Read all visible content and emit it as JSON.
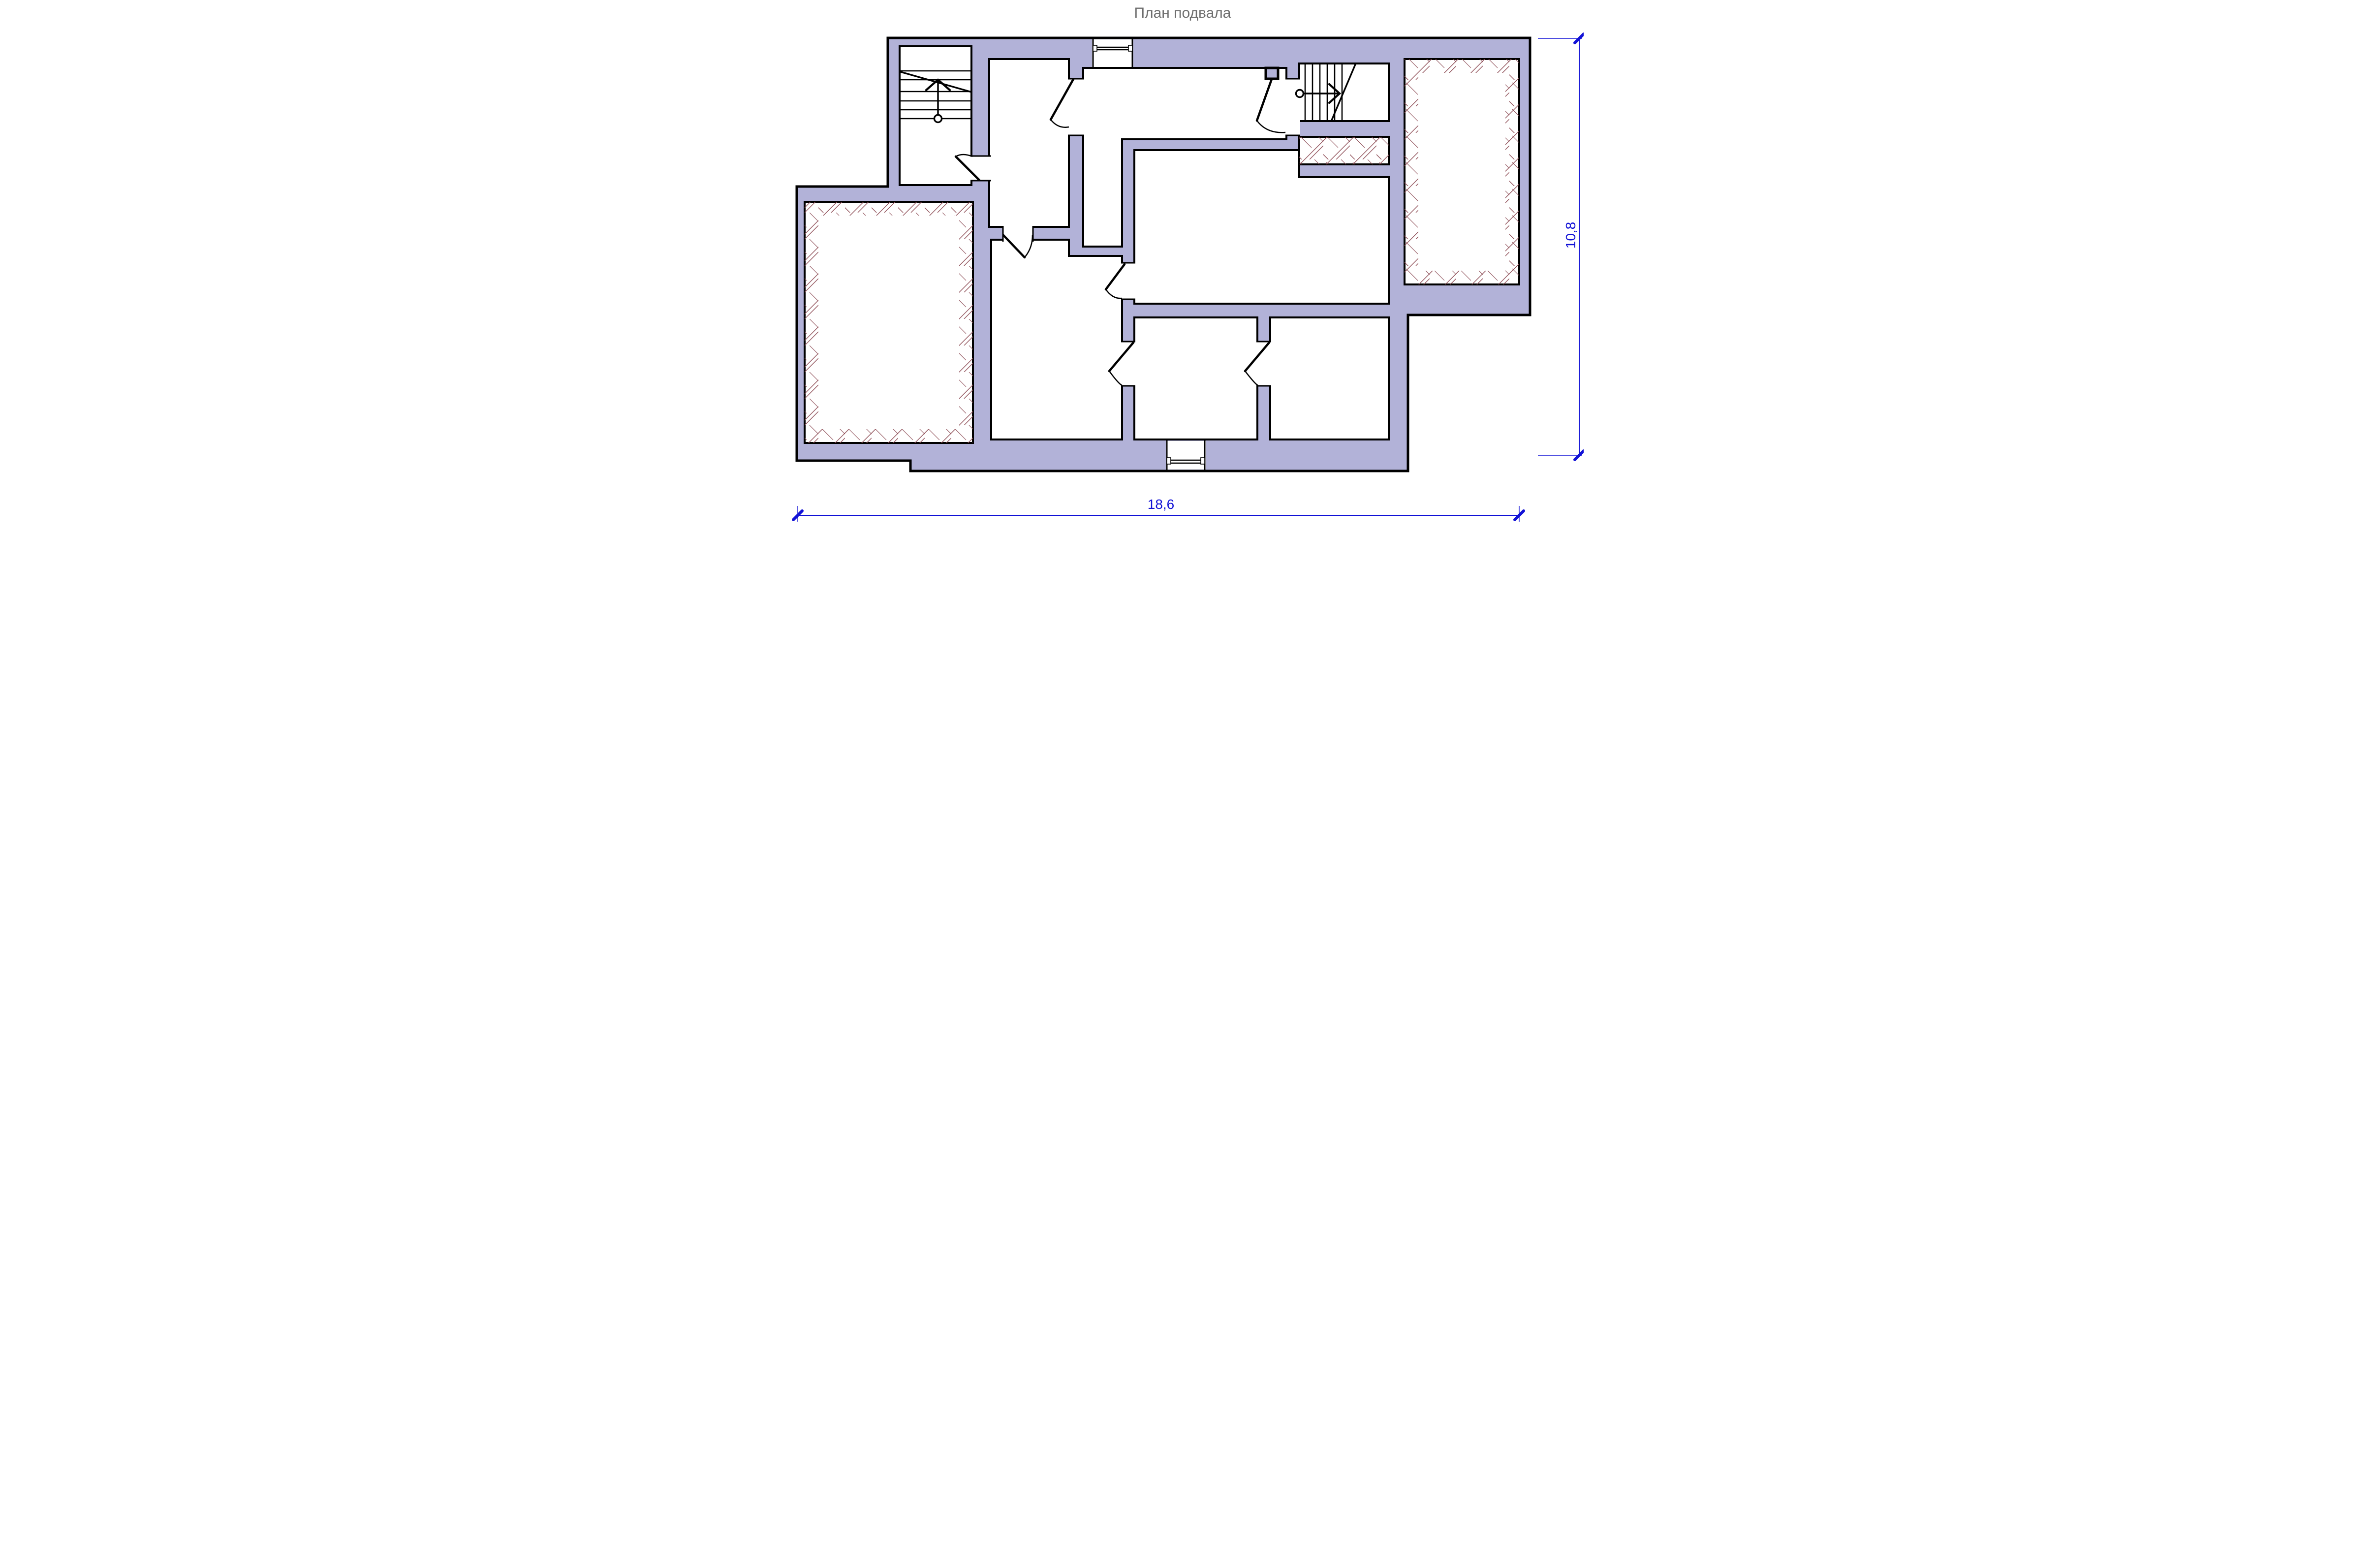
{
  "drawing": {
    "title": "План подвала"
  },
  "dimensions": {
    "overall_width_label": "18,6",
    "overall_height_label": "10,8"
  },
  "colors": {
    "wall_fill": "#b2b2d8",
    "wall_outline": "#000000",
    "dimension_blue": "#1212d6",
    "hatch_red": "#8f4f58",
    "title_gray": "#6e6e6e",
    "background": "#ffffff"
  },
  "symbols": {
    "stair_left": "stair flight up with direction arrow, start circle and break line",
    "stair_right": "stair flight right with direction arrow, start circle and break line",
    "door": "door leaf with quarter-circle swing arc",
    "window": "double glazing line in wall opening",
    "hatch": "unexcavated / duct area cross hatch"
  }
}
